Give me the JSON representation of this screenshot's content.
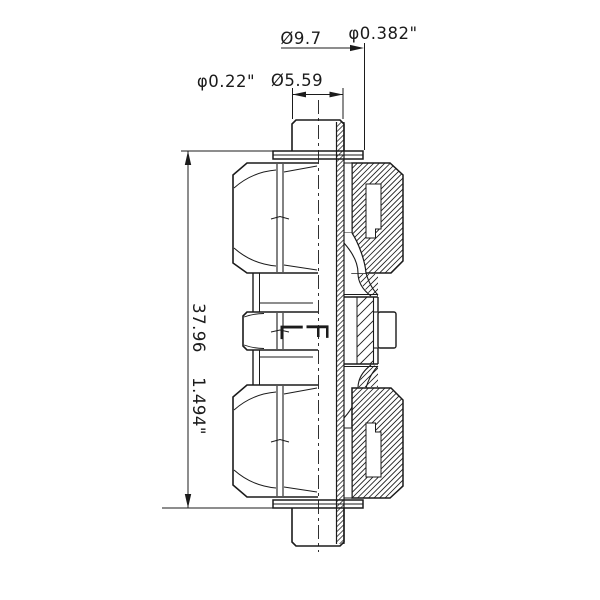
{
  "page": {
    "background": "#ffffff"
  },
  "drawing": {
    "type": "technical-drawing",
    "subject": "compression bulkhead union fitting, half-section view",
    "line_color": "#1b1b1b",
    "labels": {
      "length_mm": "37.96",
      "length_in": "1.494\"",
      "flange_dia_mm": "Ø9.7",
      "flange_dia_in": "φ0.382\"",
      "stem_dia_mm": "Ø5.59",
      "stem_dia_in": "φ0.22\""
    },
    "marking": {
      "text": "LF",
      "char_1": "L",
      "char_2": "F"
    }
  }
}
